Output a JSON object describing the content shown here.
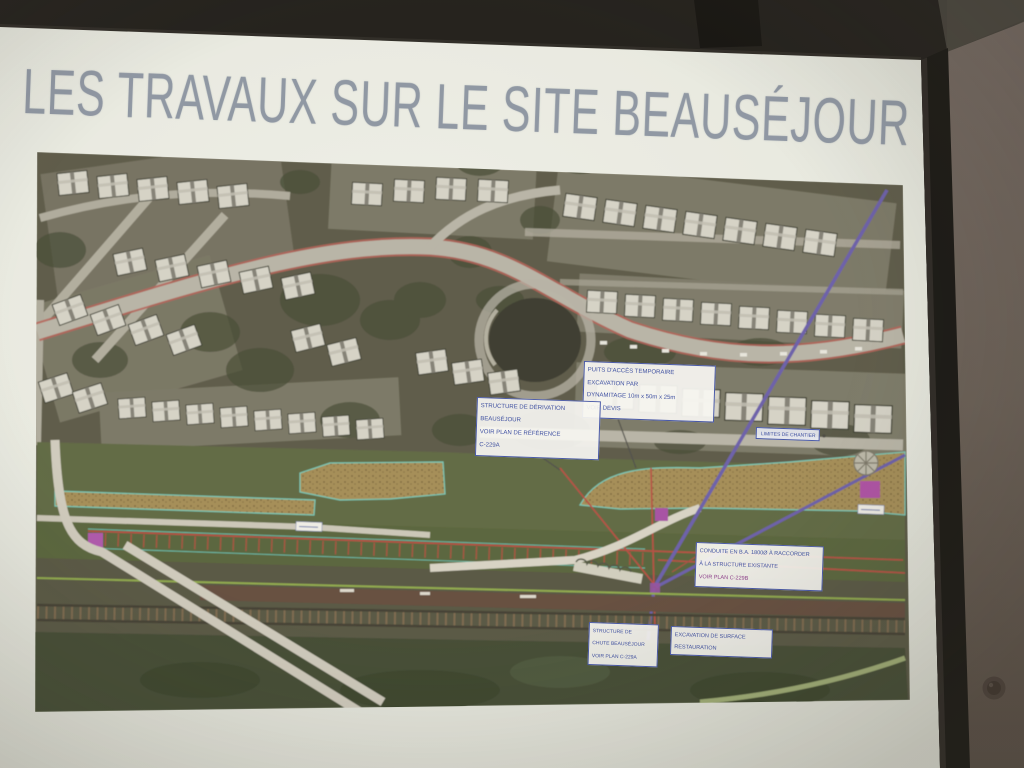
{
  "slide": {
    "title": "LES TRAVAUX SUR LE SITE BEAUSÉJOUR"
  },
  "map": {
    "annotations": {
      "access_shaft": {
        "l1": "PUITS D'ACCÈS TEMPORAIRE",
        "l2": "EXCAVATION PAR",
        "l3": "DYNAMITAGE 10m x 50m x 25m",
        "l4": "VOIR DEVIS"
      },
      "diversion": {
        "l1": "STRUCTURE DE DÉRIVATION",
        "l2": "BEAUSÉJOUR",
        "l3": "VOIR PLAN DE RÉFÉRENCE",
        "l4": "C-229A"
      },
      "conduit": {
        "l1": "CONDUITE EN B.A. 1800Ø À RACCORDER",
        "l2": "À LA STRUCTURE EXISTANTE",
        "l3": "VOIR PLAN C-229B"
      },
      "chute": {
        "l1": "STRUCTURE DE",
        "l2": "CHUTE BEAUSÉJOUR",
        "l3": "VOIR PLAN C-229A"
      },
      "surface_excavation": {
        "l1": "EXCAVATION DE SURFACE",
        "l2": "RESTAURATION"
      },
      "site_limit": {
        "l1": "LIMITES DE CHANTIER"
      }
    }
  },
  "colors": {
    "slide_background": "#e9ebe3",
    "title_text": "#8d96a4",
    "annotation_blue": "#3a4da3",
    "annotation_red": "#b23a30",
    "excavation_tan": "#9c8347",
    "teal_outline": "#6cc5b2",
    "pipeline_purple": "#5b4da5",
    "marker_magenta": "#a844a8",
    "road_edge_red": "#b05048",
    "screen_frame_black": "#141310",
    "wall_brown": "#6b6058"
  }
}
